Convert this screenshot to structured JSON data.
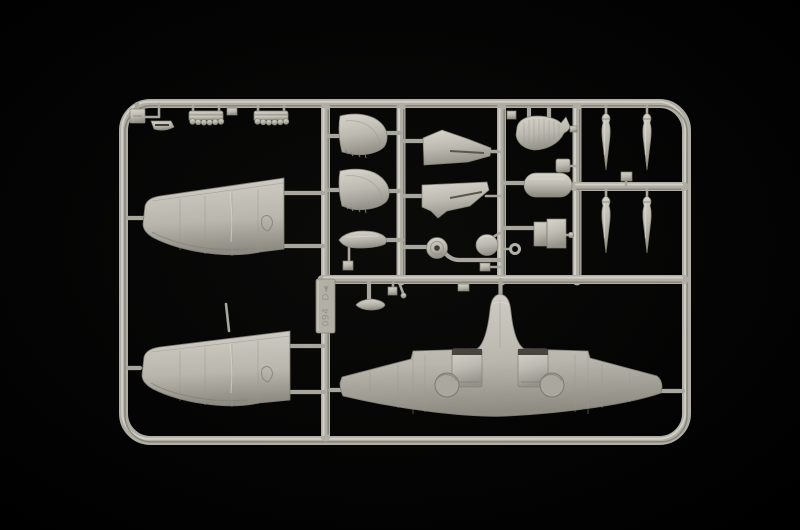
{
  "scene": {
    "subject": "photograph of a light grey injection-molded model kit sprue with aircraft parts on a black background",
    "background_color": "#000000",
    "plastic_color": "#b8b6ac",
    "plastic_highlight": "#dcdad2",
    "plastic_shadow": "#7e7c72"
  },
  "sprue": {
    "mold_tag": {
      "letter_text": "D◄",
      "number_text": "094"
    },
    "parts": [
      {
        "name": "upper-wing-half-top-left",
        "label": "Wing upper half"
      },
      {
        "name": "upper-wing-half-bottom-left",
        "label": "Wing upper half (opposite)"
      },
      {
        "name": "one-piece-lower-wing",
        "label": "One-piece lower wing with wheel wells and radiator housings"
      },
      {
        "name": "stabilizer-half-1",
        "label": "Horizontal stabilizer half"
      },
      {
        "name": "stabilizer-half-2",
        "label": "Horizontal stabilizer half"
      },
      {
        "name": "cowling-panel-1",
        "label": "Cowling / flap panel"
      },
      {
        "name": "cowling-panel-2",
        "label": "Cowling / flap panel"
      },
      {
        "name": "wing-fillet-part",
        "label": "Ribbed fillet panel"
      },
      {
        "name": "drop-tank-part",
        "label": "Cylindrical drop tank"
      },
      {
        "name": "radiator-housing-part",
        "label": "Radiator housing blocks"
      },
      {
        "name": "wheel-part",
        "label": "Main wheel"
      },
      {
        "name": "spinner-part",
        "label": "Propeller spinner"
      },
      {
        "name": "tow-ring-part",
        "label": "Small ring"
      },
      {
        "name": "slipper-tank-part",
        "label": "Slipper tank / teardrop fairing"
      },
      {
        "name": "tail-fairing-small-part",
        "label": "Small teardrop fairing"
      },
      {
        "name": "exhaust-stack-1",
        "label": "Exhaust stack"
      },
      {
        "name": "exhaust-stack-2",
        "label": "Exhaust stack"
      },
      {
        "name": "intake-scoop-part",
        "label": "Carburettor intake scoop"
      },
      {
        "name": "bracket-part",
        "label": "Small bracket"
      },
      {
        "name": "bomb-part-1",
        "label": "Bomb / rocket"
      },
      {
        "name": "bomb-part-2",
        "label": "Bomb / rocket"
      },
      {
        "name": "bomb-part-3",
        "label": "Bomb / rocket"
      },
      {
        "name": "bomb-part-4",
        "label": "Bomb / rocket"
      },
      {
        "name": "small-fittings",
        "label": "Assorted small fittings"
      }
    ]
  }
}
